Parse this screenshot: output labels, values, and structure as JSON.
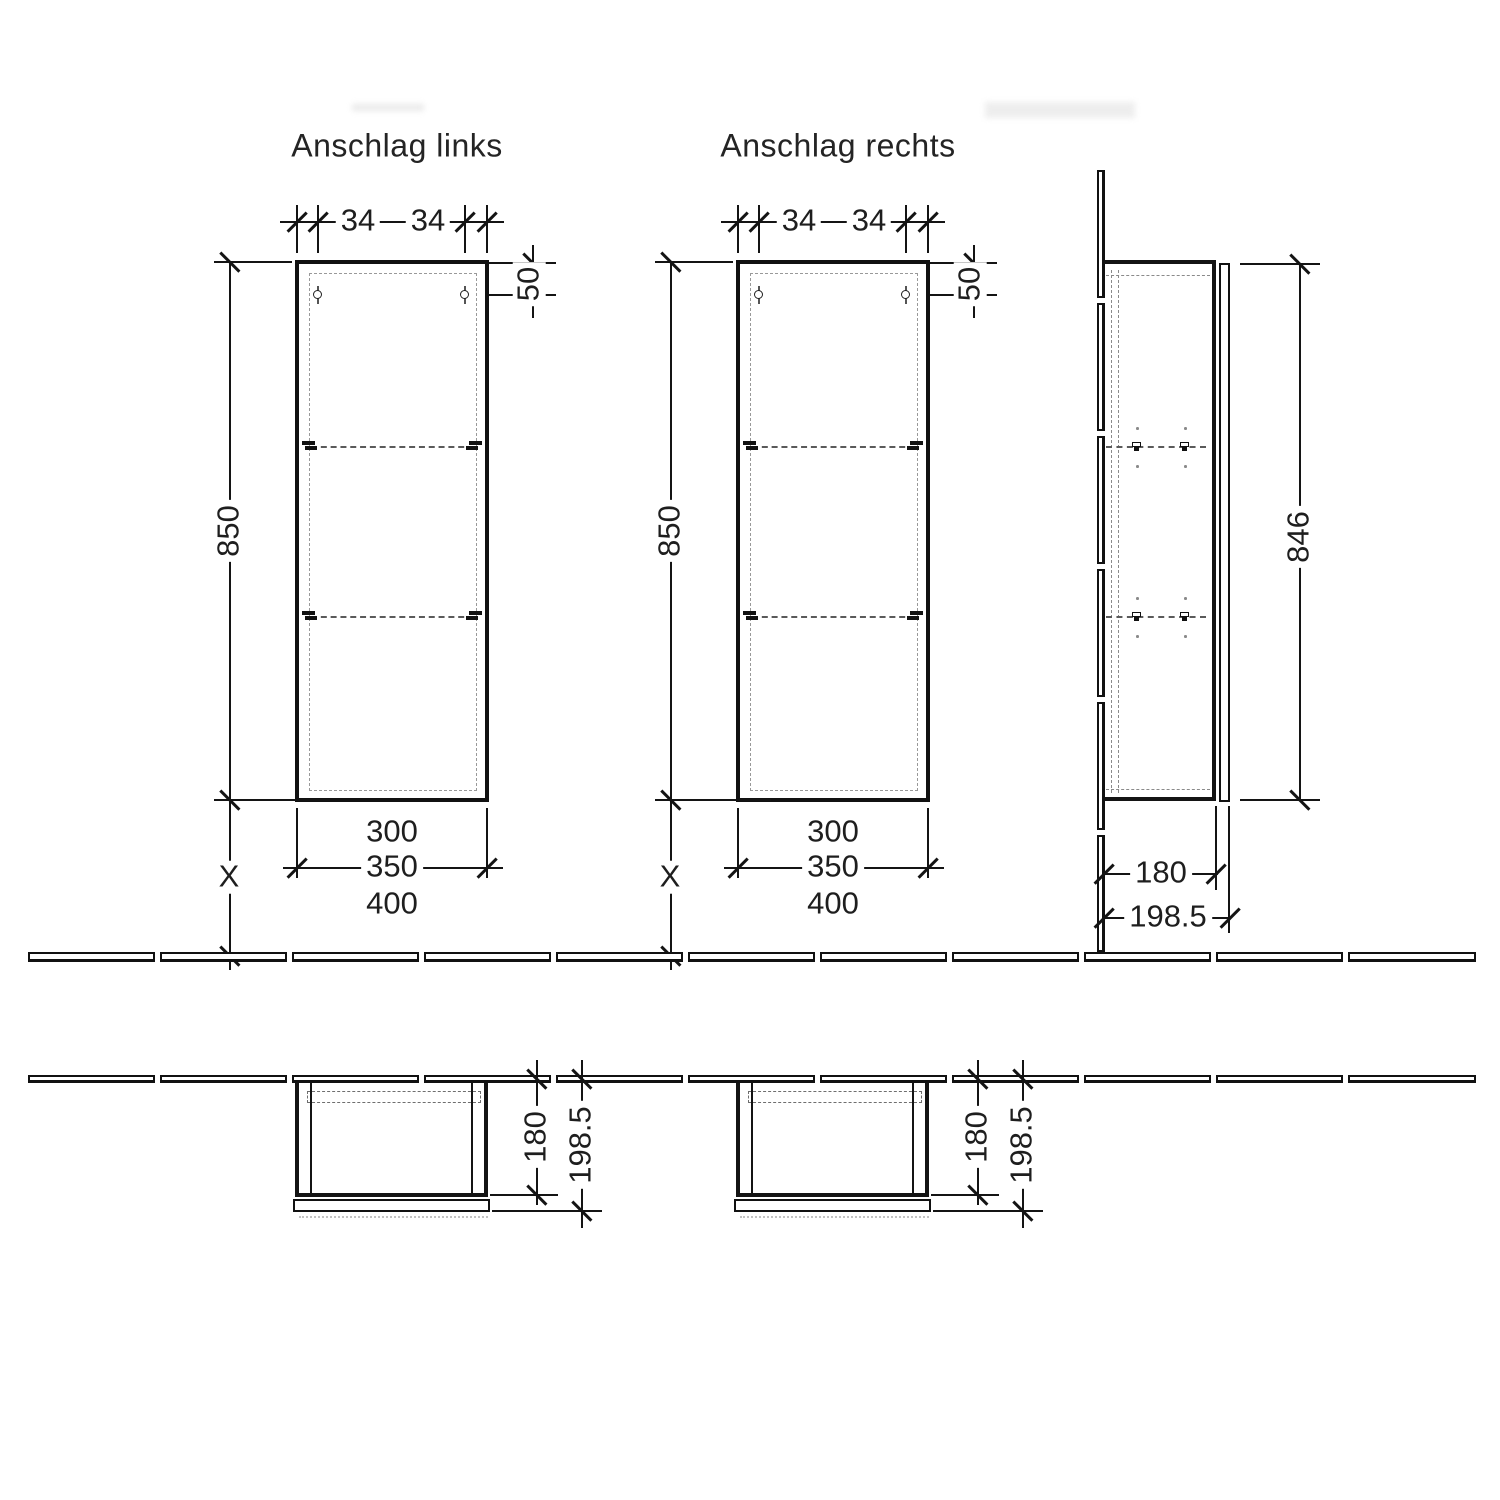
{
  "front_left": {
    "title": "Anschlag links",
    "hole_offset_left": "34",
    "hole_offset_right": "34",
    "hole_drop": "50",
    "height": "850",
    "floor_gap": "X",
    "width_inner": "300",
    "width_body": "350",
    "width_overall": "400"
  },
  "front_right": {
    "title": "Anschlag rechts",
    "hole_offset_left": "34",
    "hole_offset_right": "34",
    "hole_drop": "50",
    "height": "850",
    "floor_gap": "X",
    "width_inner": "300",
    "width_body": "350",
    "width_overall": "400"
  },
  "side": {
    "door_height": "846",
    "depth_body": "180",
    "depth_overall": "198.5"
  },
  "plan_left": {
    "depth_body": "180",
    "depth_overall": "198.5"
  },
  "plan_right": {
    "depth_body": "180",
    "depth_overall": "198.5"
  },
  "colors": {
    "line": "#141414",
    "dashed": "#8a8a8a",
    "background": "#ffffff"
  }
}
